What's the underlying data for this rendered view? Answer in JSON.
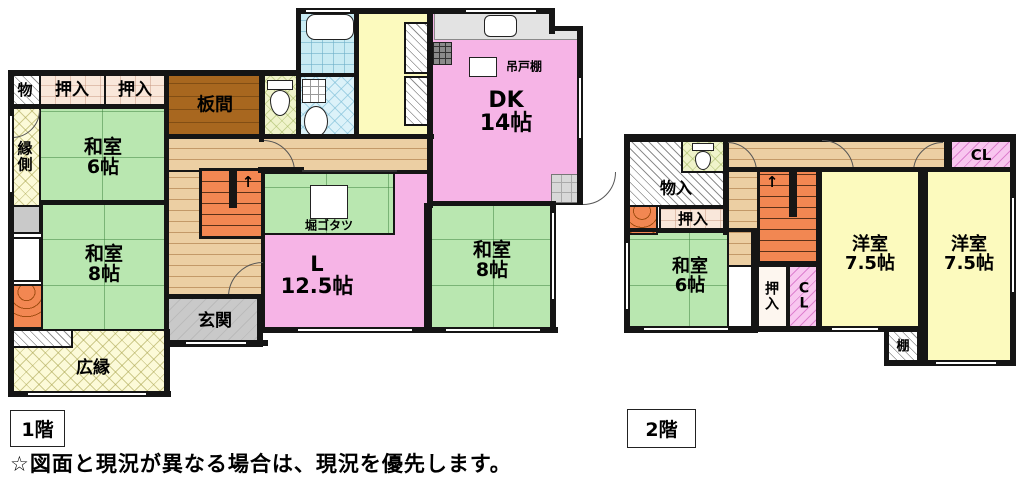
{
  "caption": "☆図面と現況が異なる場合は、現況を優先します。",
  "colors": {
    "tatami_green": "#b9e7b0",
    "dk_living_pink": "#f6b4e6",
    "western_room_yellow": "#fcfabe",
    "hall_wood": "#eccfa3",
    "itanoma_brown": "#a8671f",
    "stairs_orange": "#f28752",
    "genkan_gray": "#c9c9c9",
    "closet_hatch_pink": "#f8c6ef",
    "wall_black": "#151515"
  },
  "floor1": {
    "label": "1階",
    "stairs_arrow": "↑",
    "rooms": {
      "mono": "物",
      "oshiire_a": "押入",
      "oshiire_b": "押入",
      "itanoma": "板間",
      "engawa": "縁\n側",
      "washitsu6": "和室\n6帖",
      "dk": "DK\n14帖",
      "tsuridodana": "吊戸棚",
      "horigotatsu": "堀ゴタツ",
      "living": "L\n12.5帖",
      "washitsu8_a": "和室\n8帖",
      "washitsu8_b": "和室\n8帖",
      "genkan": "玄関",
      "hiroen": "広縁"
    }
  },
  "floor2": {
    "label": "2階",
    "stairs_arrow": "↑",
    "rooms": {
      "mononyu": "物入",
      "oshiire_top": "押入",
      "washitsu6": "和室\n6帖",
      "oshiire_v": "押\n入",
      "cl_v": "C\nL",
      "cl_top": "CL",
      "yoshitsu_a": "洋室\n7.5帖",
      "yoshitsu_b": "洋室\n7.5帖",
      "tana": "棚"
    }
  }
}
